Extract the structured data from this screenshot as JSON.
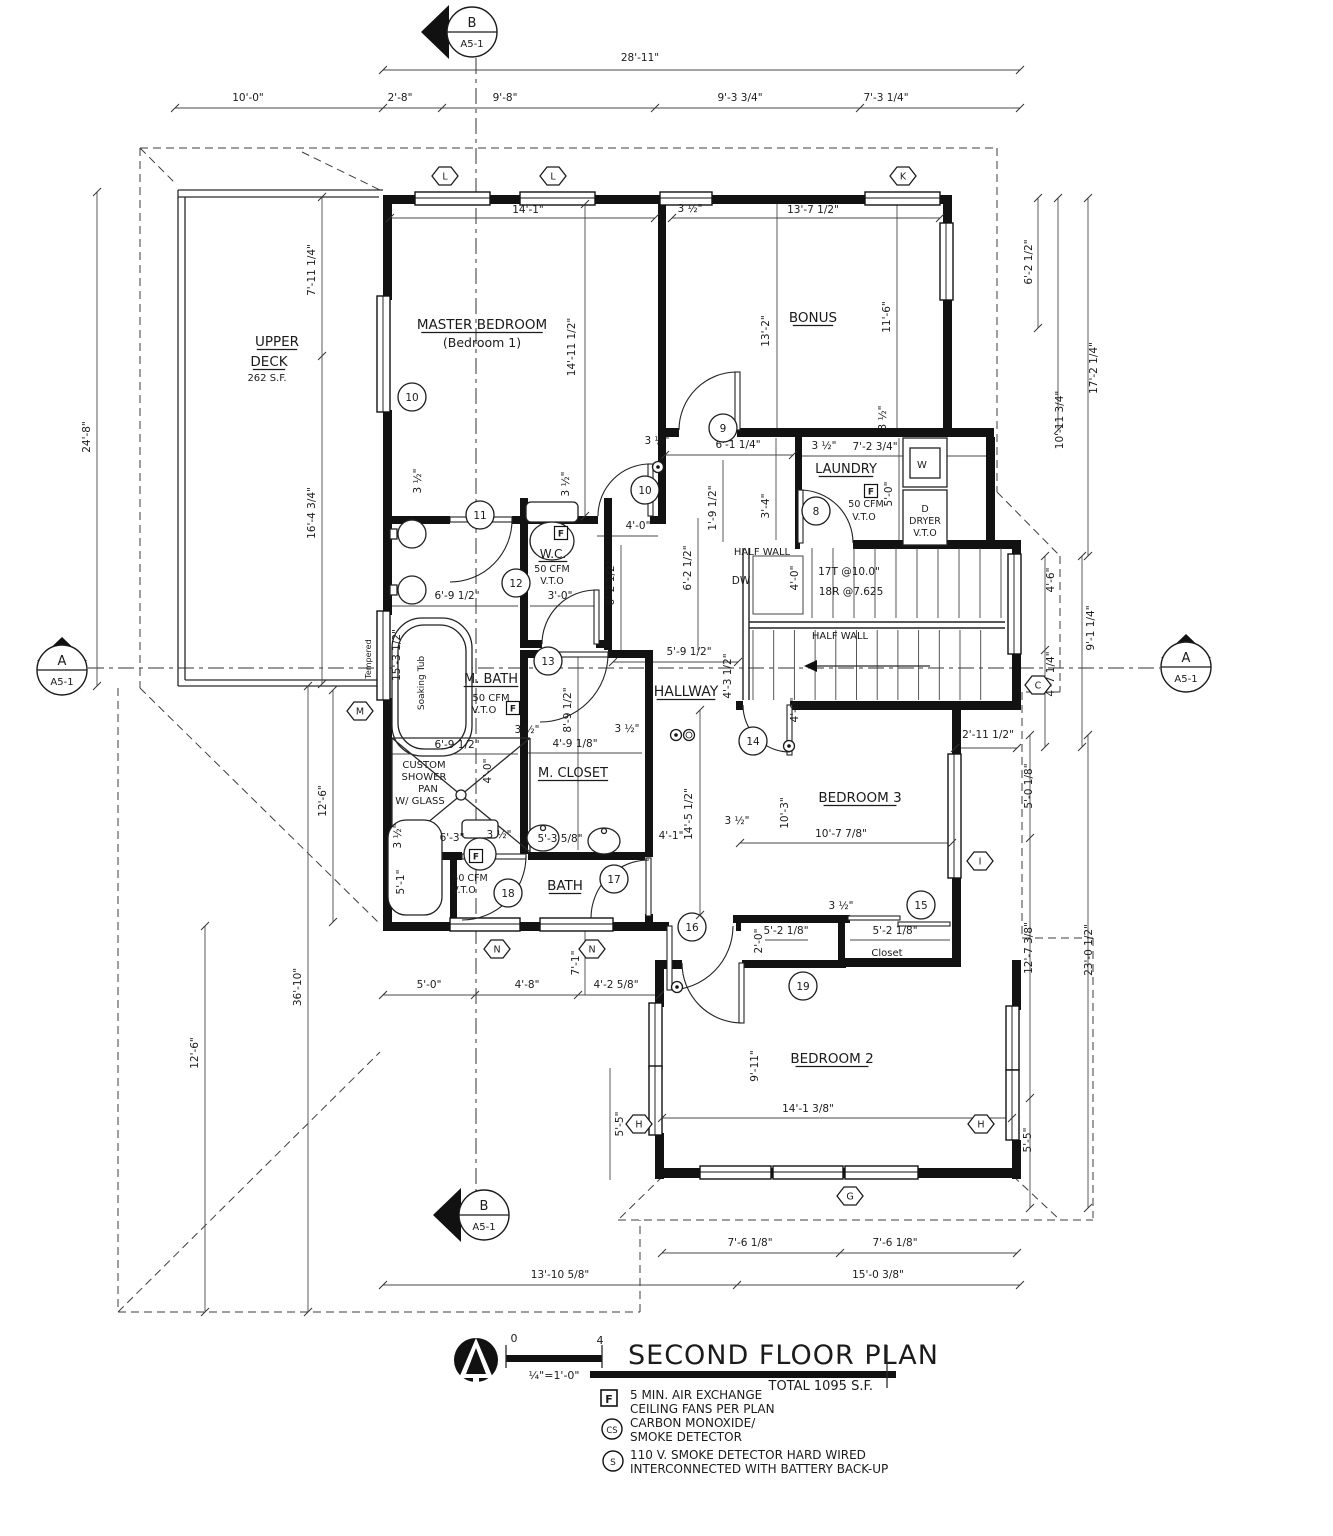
{
  "title_block": {
    "title": "SECOND FLOOR PLAN",
    "total": "TOTAL 1095 S.F.",
    "scale_zero": "0",
    "scale_four": "4",
    "scale_text": "¼\"=1'-0\""
  },
  "legend": {
    "fan_symbol": "F",
    "fan_line1": "5 MIN. AIR EXCHANGE",
    "fan_line2": "CEILING FANS PER PLAN",
    "cs_symbol": "CS",
    "cs_line1": "CARBON MONOXIDE/",
    "cs_line2": "SMOKE DETECTOR",
    "s_symbol": "S",
    "s_line1": "110 V. SMOKE DETECTOR HARD WIRED",
    "s_line2": "INTERCONNECTED WITH BATTERY BACK-UP"
  },
  "plan": {
    "labels": [
      {
        "t": "MASTER  BEDROOM",
        "x": 482,
        "y": 329,
        "s": 13.5,
        "u": 1
      },
      {
        "t": "(Bedroom 1)",
        "x": 482,
        "y": 347,
        "s": 12.5
      },
      {
        "t": "BONUS",
        "x": 813,
        "y": 322,
        "s": 13.5,
        "u": 1
      },
      {
        "t": "LAUNDRY",
        "x": 846,
        "y": 473,
        "s": 13,
        "u": 1
      },
      {
        "t": "W.C.",
        "x": 553,
        "y": 558,
        "s": 12,
        "u": 1
      },
      {
        "t": "M. BATH",
        "x": 491,
        "y": 683,
        "s": 13,
        "u": 1
      },
      {
        "t": "HALLWAY",
        "x": 686,
        "y": 696,
        "s": 14,
        "u": 1
      },
      {
        "t": "M. CLOSET",
        "x": 573,
        "y": 777,
        "s": 13,
        "u": 1
      },
      {
        "t": "BATH",
        "x": 565,
        "y": 890,
        "s": 13.5,
        "u": 1
      },
      {
        "t": "BEDROOM 3",
        "x": 860,
        "y": 802,
        "s": 13.5,
        "u": 1
      },
      {
        "t": "BEDROOM 2",
        "x": 832,
        "y": 1063,
        "s": 13.5,
        "u": 1
      },
      {
        "t": "UPPER",
        "x": 277,
        "y": 346,
        "s": 13.5,
        "u": 1
      },
      {
        "t": "DECK",
        "x": 269,
        "y": 366,
        "s": 13.5,
        "u": 1
      },
      {
        "t": "262 S.F.",
        "x": 267,
        "y": 381,
        "s": 10
      },
      {
        "t": "Closet",
        "x": 887,
        "y": 956,
        "s": 10
      },
      {
        "t": "50 CFM",
        "x": 491,
        "y": 701,
        "s": 10
      },
      {
        "t": "V.T.O",
        "x": 484,
        "y": 713,
        "s": 10
      },
      {
        "t": "50 CFM",
        "x": 552,
        "y": 572,
        "s": 9.5
      },
      {
        "t": "V.T.O",
        "x": 552,
        "y": 584,
        "s": 9.5
      },
      {
        "t": "50 CFM",
        "x": 866,
        "y": 507,
        "s": 9.5
      },
      {
        "t": "V.T.O",
        "x": 864,
        "y": 520,
        "s": 9.5
      },
      {
        "t": "50 CFM",
        "x": 470,
        "y": 881,
        "s": 9.5
      },
      {
        "t": "V.T.O",
        "x": 464,
        "y": 893,
        "s": 9.5
      },
      {
        "t": "CUSTOM",
        "x": 424,
        "y": 768,
        "s": 10
      },
      {
        "t": "SHOWER",
        "x": 424,
        "y": 780,
        "s": 10
      },
      {
        "t": "PAN",
        "x": 428,
        "y": 792,
        "s": 10
      },
      {
        "t": "W/ GLASS",
        "x": 420,
        "y": 804,
        "s": 10
      },
      {
        "t": "HALF WALL",
        "x": 762,
        "y": 555,
        "s": 10
      },
      {
        "t": "HALF WALL",
        "x": 840,
        "y": 639,
        "s": 10
      },
      {
        "t": "DW",
        "x": 741,
        "y": 584,
        "s": 10.5
      },
      {
        "t": "17T @10.0\"",
        "x": 849,
        "y": 575,
        "s": 10.5
      },
      {
        "t": "18R @7.625",
        "x": 851,
        "y": 595,
        "s": 10.5
      },
      {
        "t": "W",
        "x": 922,
        "y": 468,
        "s": 10
      },
      {
        "t": "D",
        "x": 925,
        "y": 512,
        "s": 9.5
      },
      {
        "t": "DRYER",
        "x": 925,
        "y": 524,
        "s": 9.5
      },
      {
        "t": "V.T.O",
        "x": 925,
        "y": 536,
        "s": 9.5
      },
      {
        "t": "Soaking Tub",
        "x": 424,
        "y": 683,
        "r": 1,
        "s": 9
      },
      {
        "t": "Tempered",
        "x": 371,
        "y": 659,
        "r": 1,
        "s": 8
      },
      {
        "t": "28'-11\"",
        "x": 640,
        "y": 61
      },
      {
        "t": "10'-0\"",
        "x": 248,
        "y": 101
      },
      {
        "t": "2'-8\"",
        "x": 400,
        "y": 101
      },
      {
        "t": "9'-8\"",
        "x": 505,
        "y": 101
      },
      {
        "t": "9'-3 3/4\"",
        "x": 740,
        "y": 101
      },
      {
        "t": "7'-3 1/4\"",
        "x": 886,
        "y": 101
      },
      {
        "t": "14'-1\"",
        "x": 528,
        "y": 213
      },
      {
        "t": "3 ½\"",
        "x": 690,
        "y": 212
      },
      {
        "t": "13'-7 1/2\"",
        "x": 813,
        "y": 213
      },
      {
        "t": "6'-1 1/4\"",
        "x": 738,
        "y": 448
      },
      {
        "t": "3 ½\"",
        "x": 657,
        "y": 444
      },
      {
        "t": "3 ½\"",
        "x": 824,
        "y": 449
      },
      {
        "t": "7'-2 3/4\"",
        "x": 875,
        "y": 450
      },
      {
        "t": "4'-0\"",
        "x": 638,
        "y": 529
      },
      {
        "t": "5'-9 1/2\"",
        "x": 689,
        "y": 655
      },
      {
        "t": "6'-9 1/2\"",
        "x": 457,
        "y": 599
      },
      {
        "t": "3'-0\"",
        "x": 560,
        "y": 599
      },
      {
        "t": "6'-9 1/2\"",
        "x": 457,
        "y": 748
      },
      {
        "t": "3 ½\"",
        "x": 527,
        "y": 733
      },
      {
        "t": "4'-9 1/8\"",
        "x": 575,
        "y": 747
      },
      {
        "t": "3 ½\"",
        "x": 627,
        "y": 732
      },
      {
        "t": "6'-3\"",
        "x": 452,
        "y": 841
      },
      {
        "t": "3 ½\"",
        "x": 499,
        "y": 838
      },
      {
        "t": "5'-3 5/8\"",
        "x": 560,
        "y": 842
      },
      {
        "t": "10'-7 7/8\"",
        "x": 841,
        "y": 837
      },
      {
        "t": "3 ½\"",
        "x": 841,
        "y": 909
      },
      {
        "t": "5'-2 1/8\"",
        "x": 786,
        "y": 934
      },
      {
        "t": "5'-2 1/8\"",
        "x": 895,
        "y": 934
      },
      {
        "t": "2'-11 1/2\"",
        "x": 988,
        "y": 738
      },
      {
        "t": "14'-1 3/8\"",
        "x": 808,
        "y": 1112
      },
      {
        "t": "5'-0\"",
        "x": 429,
        "y": 988
      },
      {
        "t": "4'-8\"",
        "x": 527,
        "y": 988
      },
      {
        "t": "4'-2 5/8\"",
        "x": 616,
        "y": 988
      },
      {
        "t": "7'-6 1/8\"",
        "x": 750,
        "y": 1246
      },
      {
        "t": "7'-6 1/8\"",
        "x": 895,
        "y": 1246
      },
      {
        "t": "13'-10 5/8\"",
        "x": 560,
        "y": 1278
      },
      {
        "t": "15'-0 3/8\"",
        "x": 878,
        "y": 1278
      },
      {
        "t": "4'-1\"",
        "x": 671,
        "y": 839
      },
      {
        "t": "3 ½\"",
        "x": 737,
        "y": 824
      },
      {
        "t": "14'-11 1/2\"",
        "x": 575,
        "y": 347,
        "r": 1
      },
      {
        "t": "13'-2\"",
        "x": 769,
        "y": 331,
        "r": 1
      },
      {
        "t": "11'-6\"",
        "x": 890,
        "y": 317,
        "r": 1
      },
      {
        "t": "3 ½\"",
        "x": 886,
        "y": 418,
        "r": 1
      },
      {
        "t": "7'-11 1/4\"",
        "x": 315,
        "y": 270,
        "r": 1
      },
      {
        "t": "16'-4 3/4\"",
        "x": 315,
        "y": 513,
        "r": 1
      },
      {
        "t": "24'-8\"",
        "x": 90,
        "y": 437,
        "r": 1
      },
      {
        "t": "36'-10\"",
        "x": 301,
        "y": 987,
        "r": 1
      },
      {
        "t": "12'-6\"",
        "x": 326,
        "y": 801,
        "r": 1
      },
      {
        "t": "12'-6\"",
        "x": 198,
        "y": 1053,
        "r": 1
      },
      {
        "t": "6'-2 1/2\"",
        "x": 1032,
        "y": 262,
        "r": 1
      },
      {
        "t": "10'-11 3/4\"",
        "x": 1063,
        "y": 420,
        "r": 1
      },
      {
        "t": "17'-2 1/4\"",
        "x": 1097,
        "y": 368,
        "r": 1
      },
      {
        "t": "4'-6\"",
        "x": 1054,
        "y": 580,
        "r": 1
      },
      {
        "t": "4'-7 1/4\"",
        "x": 1054,
        "y": 674,
        "r": 1
      },
      {
        "t": "9'-1 1/4\"",
        "x": 1094,
        "y": 628,
        "r": 1
      },
      {
        "t": "5'-0 1/8\"",
        "x": 1032,
        "y": 786,
        "r": 1
      },
      {
        "t": "12'-7 3/8\"",
        "x": 1032,
        "y": 948,
        "r": 1
      },
      {
        "t": "5'-5\"",
        "x": 1031,
        "y": 1140,
        "r": 1
      },
      {
        "t": "23'-0 1/2\"",
        "x": 1092,
        "y": 950,
        "r": 1
      },
      {
        "t": "5'-5\"",
        "x": 623,
        "y": 1124,
        "r": 1
      },
      {
        "t": "9'-11\"",
        "x": 758,
        "y": 1066,
        "r": 1
      },
      {
        "t": "7'-1\"",
        "x": 579,
        "y": 963,
        "r": 1
      },
      {
        "t": "15'-3 1/2\"",
        "x": 400,
        "y": 655,
        "r": 1
      },
      {
        "t": "8'-9 1/2\"",
        "x": 571,
        "y": 710,
        "r": 1
      },
      {
        "t": "6'-2 1/2\"",
        "x": 614,
        "y": 583,
        "r": 1
      },
      {
        "t": "6'-2 1/2\"",
        "x": 691,
        "y": 568,
        "r": 1
      },
      {
        "t": "4'-3 1/2\"",
        "x": 731,
        "y": 676,
        "r": 1
      },
      {
        "t": "1'-9 1/2\"",
        "x": 716,
        "y": 508,
        "r": 1
      },
      {
        "t": "3'-4\"",
        "x": 769,
        "y": 506,
        "r": 1
      },
      {
        "t": "4'-0\"",
        "x": 798,
        "y": 578,
        "r": 1
      },
      {
        "t": "4'-0\"",
        "x": 798,
        "y": 710,
        "r": 1
      },
      {
        "t": "5'-0\"",
        "x": 892,
        "y": 494,
        "r": 1
      },
      {
        "t": "4'-0\"",
        "x": 491,
        "y": 771,
        "r": 1
      },
      {
        "t": "10'-3\"",
        "x": 788,
        "y": 813,
        "r": 1
      },
      {
        "t": "2'-0\"",
        "x": 762,
        "y": 941,
        "r": 1
      },
      {
        "t": "14'-5 1/2\"",
        "x": 692,
        "y": 814,
        "r": 1
      },
      {
        "t": "3 ½\"",
        "x": 421,
        "y": 481,
        "r": 1
      },
      {
        "t": "3 ½\"",
        "x": 569,
        "y": 484,
        "r": 1
      },
      {
        "t": "3 ½\"",
        "x": 401,
        "y": 836,
        "r": 1
      },
      {
        "t": "5'-1\"",
        "x": 404,
        "y": 882,
        "r": 1
      }
    ],
    "circle_tags": [
      {
        "n": "10",
        "x": 412,
        "y": 397
      },
      {
        "n": "10",
        "x": 645,
        "y": 490
      },
      {
        "n": "11",
        "x": 480,
        "y": 515
      },
      {
        "n": "12",
        "x": 516,
        "y": 583
      },
      {
        "n": "13",
        "x": 548,
        "y": 661
      },
      {
        "n": "14",
        "x": 753,
        "y": 741
      },
      {
        "n": "15",
        "x": 921,
        "y": 905
      },
      {
        "n": "16",
        "x": 692,
        "y": 927
      },
      {
        "n": "17",
        "x": 614,
        "y": 879
      },
      {
        "n": "18",
        "x": 508,
        "y": 893
      },
      {
        "n": "19",
        "x": 803,
        "y": 986
      },
      {
        "n": "8",
        "x": 816,
        "y": 511
      },
      {
        "n": "9",
        "x": 723,
        "y": 428
      }
    ],
    "hex_tags": [
      {
        "n": "L",
        "x": 445,
        "y": 176
      },
      {
        "n": "L",
        "x": 553,
        "y": 176
      },
      {
        "n": "K",
        "x": 903,
        "y": 176
      },
      {
        "n": "M",
        "x": 360,
        "y": 711
      },
      {
        "n": "N",
        "x": 497,
        "y": 949
      },
      {
        "n": "N",
        "x": 592,
        "y": 949
      },
      {
        "n": "G",
        "x": 850,
        "y": 1196
      },
      {
        "n": "H",
        "x": 639,
        "y": 1124
      },
      {
        "n": "H",
        "x": 981,
        "y": 1124
      },
      {
        "n": "I",
        "x": 980,
        "y": 861
      },
      {
        "n": "C",
        "x": 1038,
        "y": 685
      }
    ],
    "markers": [
      {
        "x": 472,
        "y": 32,
        "a": "B",
        "b": "A5-1",
        "d": "w"
      },
      {
        "x": 484,
        "y": 1215,
        "a": "B",
        "b": "A5-1",
        "d": "w"
      },
      {
        "x": 62,
        "y": 670,
        "a": "A",
        "b": "A5-1",
        "d": "n"
      },
      {
        "x": 1186,
        "y": 667,
        "a": "A",
        "b": "A5-1",
        "d": "n"
      }
    ],
    "detectors": {
      "s": [
        [
          658,
          467
        ],
        [
          676,
          735
        ],
        [
          789,
          746
        ],
        [
          677,
          987
        ]
      ],
      "cs": [
        [
          689,
          735
        ]
      ]
    },
    "f_boxes": [
      [
        561,
        533
      ],
      [
        513,
        708
      ],
      [
        871,
        491
      ],
      [
        476,
        856
      ]
    ]
  }
}
